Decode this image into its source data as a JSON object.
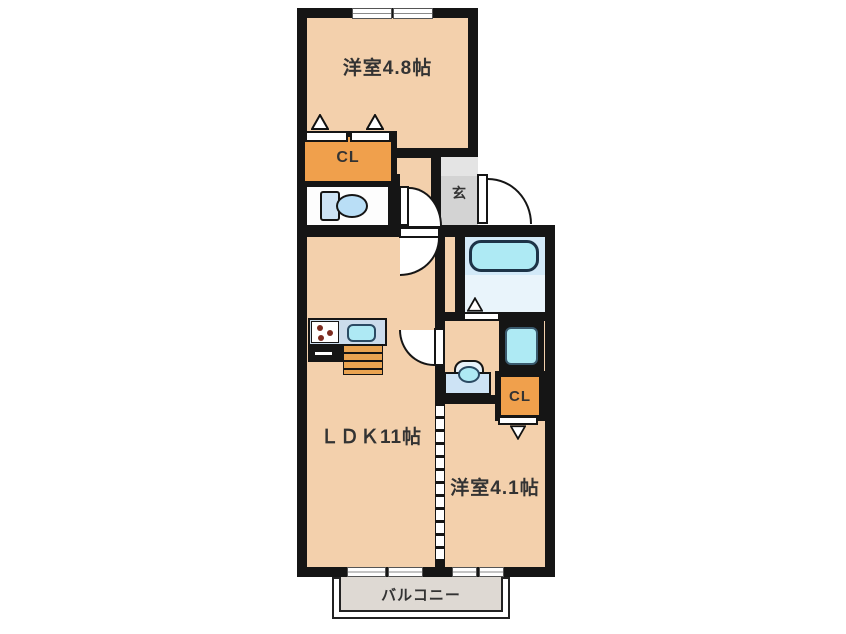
{
  "title": "apartment-floor-plan",
  "labels": {
    "bedroom1": "洋室4.8帖",
    "ldk": "ＬＤＫ11帖",
    "bedroom2": "洋室4.1帖",
    "genkan": "玄",
    "closet1": "CL",
    "closet2": "CL",
    "balcony": "バルコニー"
  },
  "rooms": [
    {
      "id": "bedroom1",
      "label": "洋室4.8帖",
      "type": "western-room"
    },
    {
      "id": "ldk",
      "label": "ＬＤＫ11帖",
      "type": "living-dining-kitchen"
    },
    {
      "id": "bedroom2",
      "label": "洋室4.1帖",
      "type": "western-room"
    },
    {
      "id": "genkan",
      "label": "玄",
      "type": "entrance"
    },
    {
      "id": "closet1",
      "label": "CL",
      "type": "closet"
    },
    {
      "id": "closet2",
      "label": "CL",
      "type": "closet"
    },
    {
      "id": "balcony",
      "label": "バルコニー",
      "type": "balcony"
    }
  ],
  "fixtures": [
    "toilet",
    "bathtub",
    "gas-stove",
    "kitchen-sink",
    "washing-machine-pan",
    "vanity-basin"
  ],
  "colors": {
    "wall": "#151515",
    "floor": "#f3d0ac",
    "closet": "#f0a04c",
    "genkan": "#d3d3d3",
    "genkan_step": "#e4e4e4",
    "bath_upper": "#d2e9f8",
    "bath_lower": "#e9f4fb",
    "fixture_cyan": "#aeeaf4",
    "fixture_blue": "#cde3f5",
    "kitchen_counter": "#ccdcec",
    "cabinet_stripe": "#e9a351",
    "balcony_floor": "#ded9d3",
    "text": "#333333"
  }
}
